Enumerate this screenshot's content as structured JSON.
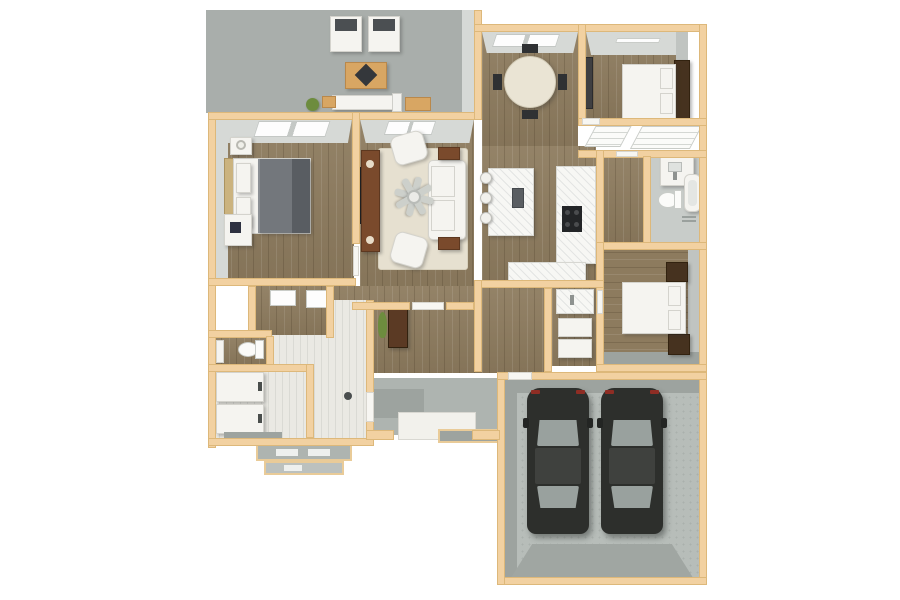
{
  "scene": {
    "description": "3D top-down dollhouse rendering of a single-story house floor plan with attached two-car garage",
    "background": "#ffffff",
    "visible_text": "none"
  },
  "palette": {
    "wall_tan": "#f2d1a1",
    "wall_trim": "#ddb87a",
    "wood_floor": "#8d7b5e",
    "patio_concrete": "#a9aeab",
    "garage_concrete": "#b7bdb9",
    "driveway_apron": "#a0a6a2",
    "entry_tile": "#eae9e3",
    "bath_floor": "#c8ccc9",
    "wall_face_light": "#d6d9d6",
    "wall_face_dark": "#9da39f",
    "rug": "#e6e0d0",
    "white_furniture": "#f5f4f0",
    "marble_counter": "#f7f7f4",
    "duvet_gray": "#73777c",
    "brown_furniture": "#7a4a2c",
    "dark_headboard": "#46321f",
    "car_body": "#2d2f2c",
    "car_glass": "#99a19e",
    "car_tail_light": "#8e2d24",
    "plant_green": "#6d8c3e"
  },
  "rooms": [
    "covered-patio",
    "master-bedroom",
    "living-room",
    "dining-area",
    "kitchen",
    "bedroom-2",
    "bedroom-3",
    "hall-bathroom",
    "master-bathroom",
    "toilet-room",
    "walk-in-closet",
    "laundry-utility",
    "entry-foyer",
    "hallway",
    "front-porch",
    "garage"
  ],
  "inventory": {
    "cars": 2,
    "beds": 3,
    "patio_chairs": 2,
    "dining_chairs": 4,
    "bar_stools": 3,
    "sofas": 1,
    "armchairs": 2,
    "ceiling_fans": 1,
    "toilets": 2,
    "bathtubs": 1,
    "shower_units": 2,
    "washer_dryer_units": 2,
    "tv_screens": 1,
    "windows_front": 4,
    "porch_step_flights": 2
  }
}
